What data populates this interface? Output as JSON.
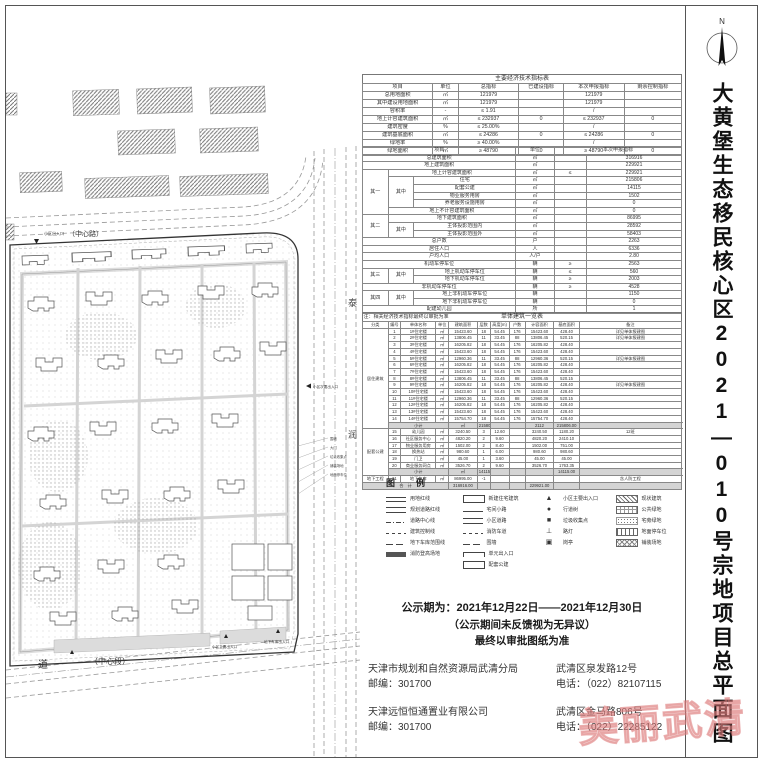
{
  "title": {
    "vertical_text": "大黄堡生态移民核心区2021—010号宗地项目总平面图"
  },
  "north_arrow": {
    "label": "N"
  },
  "map": {
    "road_top_entrance": "小区出入口",
    "road_top_label": "（中心路）",
    "road_bottom_name": "道",
    "road_bottom_section": "（中心段）",
    "entrance_main": "小区主要出入口",
    "entrance_secondary": "小区次要出入口",
    "entrance_garage": "地下车库出入口",
    "road_right_char1": "泰",
    "road_right_char2": "润",
    "annotation_lines": [
      "围墙",
      "大门",
      "垃圾收集点",
      "铺装场地",
      "地面停车位"
    ]
  },
  "tables": {
    "t1": {
      "title": "主要经济技术指标表",
      "widths": [
        22,
        8,
        19,
        14,
        19,
        18
      ],
      "header": [
        "项目",
        "单位",
        "总指标",
        "已建设指标",
        "本次申报指标",
        "剩余控制指标"
      ],
      "rows": [
        [
          "总用地面积",
          "㎡",
          "121979",
          "",
          "121979",
          ""
        ],
        [
          "其中建设用地面积",
          "㎡",
          "121979",
          "",
          "121979",
          ""
        ],
        [
          "容积率",
          "-",
          "≤ 1.91",
          "",
          "/",
          ""
        ],
        [
          "地上计容建筑面积",
          "㎡",
          "≤ 232937",
          "0",
          "≤ 232937",
          "0"
        ],
        [
          "建筑密度",
          "%",
          "≤ 25.00%",
          "",
          "/",
          ""
        ],
        [
          "建筑基底面积",
          "㎡",
          "≤ 24286",
          "0",
          "≤ 24286",
          "0"
        ],
        [
          "绿地率",
          "%",
          "≥ 40.00%",
          "",
          "/",
          ""
        ],
        [
          "绿地面积",
          "㎡",
          "≥ 48790",
          "0",
          "≥ 48790",
          "0"
        ]
      ]
    },
    "t2": {
      "widths": [
        8,
        8,
        32,
        12,
        10,
        30
      ],
      "header": [
        [
          {
            "t": "项目",
            "cs": 3
          },
          {
            "t": "单位"
          },
          {
            "t": "本次申报指标",
            "cs": 2
          }
        ]
      ],
      "rows": [
        [
          {
            "t": "总建筑面积",
            "cs": 3
          },
          "㎡",
          "",
          "316916"
        ],
        [
          {
            "t": "地上建筑面积",
            "cs": 3
          },
          "㎡",
          "",
          "229921"
        ],
        [
          {
            "t": "其一",
            "rs": 6
          },
          {
            "t": "地上计容建筑面积",
            "cs": 2
          },
          "㎡",
          "≤",
          "229921"
        ],
        [
          {
            "t": "其中",
            "rs": 4
          },
          {
            "t": "住宅"
          },
          "㎡",
          "",
          "215806"
        ],
        [
          {
            "t": "配套公建"
          },
          "㎡",
          "",
          "14115"
        ],
        [
          {
            "t": "物业服务用房"
          },
          "㎡",
          "",
          "1502"
        ],
        [
          {
            "t": "养老服务设施用房"
          },
          "㎡",
          "",
          "0"
        ],
        [
          {
            "t": "地上不计容建筑面积",
            "cs": 2
          },
          "㎡",
          "",
          "0"
        ],
        [
          {
            "t": "其二",
            "rs": 3
          },
          {
            "t": "地下建筑面积",
            "cs": 2
          },
          "㎡",
          "",
          "86995"
        ],
        [
          {
            "t": "其中",
            "rs": 2
          },
          {
            "t": "主体投影范围内"
          },
          "㎡",
          "",
          "28592"
        ],
        [
          {
            "t": "主体投影范围外"
          },
          "㎡",
          "",
          "58403"
        ],
        [
          {
            "t": "总户数",
            "cs": 3
          },
          "户",
          "",
          "2263"
        ],
        [
          {
            "t": "居住人口",
            "cs": 3
          },
          "人",
          "",
          "6336"
        ],
        [
          {
            "t": "户均人口",
            "cs": 3
          },
          "人/户",
          "",
          "2.80"
        ],
        [
          {
            "t": "机动车停车位",
            "cs": 3
          },
          "辆",
          "≥",
          "2563"
        ],
        [
          {
            "t": "其三",
            "rs": 2
          },
          {
            "t": "其中",
            "rs": 2
          },
          {
            "t": "地上机动车停车位"
          },
          "辆",
          "≤",
          "560"
        ],
        [
          {
            "t": "地下机动车停车位"
          },
          "辆",
          "≥",
          "2003"
        ],
        [
          {
            "t": "非机动车停车位",
            "cs": 3
          },
          "辆",
          "≥",
          "4528"
        ],
        [
          {
            "t": "其四",
            "rs": 2
          },
          {
            "t": "其中",
            "rs": 2
          },
          {
            "t": "地上非机动车停车位"
          },
          "辆",
          "",
          "1150"
        ],
        [
          {
            "t": "地下非机动车停车位"
          },
          "辆",
          "",
          "0"
        ],
        [
          {
            "t": "配建幼儿园",
            "cs": 3
          },
          "所",
          "",
          "1"
        ]
      ],
      "note": "注：相关经济技术指标最终以审批为准"
    },
    "t3": {
      "title": "单体建筑一览表",
      "widths": [
        8,
        4,
        11,
        4,
        9,
        4,
        6,
        5,
        9,
        8,
        32
      ],
      "header": [
        "分类",
        "编号",
        "单体名称",
        "单位",
        "建筑面积",
        "层数",
        "高度(m)",
        "户数",
        "计容面积",
        "基底面积",
        "备注"
      ],
      "shaded": [
        14,
        21,
        23
      ],
      "rows": [
        [
          {
            "t": "居住建筑",
            "rs": 15
          },
          "1",
          "1#住宅楼",
          "㎡",
          "15423.60",
          "18",
          "54.45",
          "176",
          "15423.60",
          "428.40",
          "详见单体报建图"
        ],
        [
          "2",
          "2#住宅楼",
          "㎡",
          "13806.45",
          "11",
          "33.45",
          "88",
          "13806.45",
          "520.15",
          "详见单体报建图"
        ],
        [
          "3",
          "3#住宅楼",
          "㎡",
          "16205.82",
          "18",
          "54.45",
          "176",
          "16205.82",
          "428.40",
          ""
        ],
        [
          "4",
          "4#住宅楼",
          "㎡",
          "15423.60",
          "18",
          "54.45",
          "176",
          "15423.60",
          "428.40",
          ""
        ],
        [
          "5",
          "5#住宅楼",
          "㎡",
          "12960.36",
          "11",
          "33.45",
          "88",
          "12960.36",
          "520.15",
          "详见单体报建图"
        ],
        [
          "6",
          "6#住宅楼",
          "㎡",
          "16205.82",
          "18",
          "54.45",
          "176",
          "16205.82",
          "428.40",
          ""
        ],
        [
          "7",
          "7#住宅楼",
          "㎡",
          "15423.60",
          "18",
          "54.45",
          "176",
          "15423.60",
          "428.40",
          ""
        ],
        [
          "8",
          "8#住宅楼",
          "㎡",
          "13806.45",
          "11",
          "33.45",
          "88",
          "13806.45",
          "520.15",
          ""
        ],
        [
          "9",
          "9#住宅楼",
          "㎡",
          "16205.82",
          "18",
          "54.45",
          "176",
          "16205.82",
          "428.40",
          "详见单体报建图"
        ],
        [
          "10",
          "10#住宅楼",
          "㎡",
          "15423.60",
          "18",
          "54.45",
          "176",
          "15423.60",
          "428.40",
          ""
        ],
        [
          "11",
          "11#住宅楼",
          "㎡",
          "12960.36",
          "11",
          "33.45",
          "88",
          "12960.36",
          "520.15",
          ""
        ],
        [
          "12",
          "12#住宅楼",
          "㎡",
          "16205.82",
          "18",
          "54.45",
          "176",
          "16205.82",
          "428.40",
          ""
        ],
        [
          "13",
          "13#住宅楼",
          "㎡",
          "15423.60",
          "18",
          "54.45",
          "176",
          "15423.60",
          "428.40",
          ""
        ],
        [
          "14",
          "14#住宅楼",
          "㎡",
          "15754.70",
          "18",
          "54.45",
          "176",
          "15754.70",
          "428.40",
          ""
        ],
        [
          {
            "t": "小计",
            "cs": 3
          },
          "㎡",
          "215806.00",
          "",
          "",
          "2112",
          "215806.00",
          "",
          ""
        ],
        [
          {
            "t": "配套公建",
            "rs": 7
          },
          "15",
          "幼儿园",
          "㎡",
          "3240.50",
          "3",
          "12.60",
          "",
          "3240.50",
          "1180.20",
          "12班"
        ],
        [
          "16",
          "社区服务中心",
          "㎡",
          "4820.20",
          "2",
          "9.60",
          "",
          "4820.20",
          "2410.10",
          ""
        ],
        [
          "17",
          "物业服务用房",
          "㎡",
          "1502.00",
          "2",
          "8.40",
          "",
          "1502.00",
          "751.00",
          ""
        ],
        [
          "18",
          "换热站",
          "㎡",
          "980.60",
          "1",
          "6.00",
          "",
          "980.60",
          "980.60",
          ""
        ],
        [
          "19",
          "门卫",
          "㎡",
          "45.00",
          "1",
          "3.60",
          "",
          "45.00",
          "45.00",
          ""
        ],
        [
          "20",
          "商业服务网点",
          "㎡",
          "3526.70",
          "2",
          "9.60",
          "",
          "3526.70",
          "1763.35",
          ""
        ],
        [
          {
            "t": "小计",
            "cs": 3
          },
          "㎡",
          "14115.00",
          "",
          "",
          "",
          "14115.00",
          "",
          ""
        ],
        [
          {
            "t": "地下工程"
          },
          "21",
          "地下车库",
          "㎡",
          "86995.00",
          "-1",
          "",
          "",
          "",
          "",
          "含人防工程"
        ],
        [
          {
            "t": "合　计",
            "cs": 4
          },
          "316916.00",
          "",
          "",
          "",
          "229921.00",
          "",
          ""
        ]
      ]
    }
  },
  "legend": {
    "title": "图　例",
    "groups": [
      [
        {
          "sym": "dline",
          "label": "用地红线"
        },
        {
          "sym": "dbl",
          "label": "规划道路红线"
        },
        {
          "sym": "dashdot",
          "label": "道路中心线"
        },
        {
          "sym": "dash",
          "label": "建筑控制线"
        },
        {
          "sym": "ldash",
          "label": "地下车库范围线"
        },
        {
          "sym": "solid",
          "label": "消防登高场地"
        }
      ],
      [
        {
          "sym": "rect",
          "label": "新建住宅建筑"
        },
        {
          "sym": "line",
          "label": "宅间小路"
        },
        {
          "sym": "dbl",
          "label": "小区道路"
        },
        {
          "sym": "dash",
          "label": "消防车道"
        },
        {
          "sym": "ldash",
          "label": "围墙"
        },
        {
          "sym": "bracket",
          "label": "单元出入口"
        },
        {
          "sym": "rect",
          "label": "配套公建"
        }
      ],
      [
        {
          "sym": "tri",
          "label": "小区主要出入口"
        },
        {
          "sym": "dot",
          "label": "行道树"
        },
        {
          "sym": "sq",
          "label": "垃圾收集点"
        },
        {
          "sym": "tee",
          "label": "路灯"
        },
        {
          "sym": "box",
          "label": "岗亭"
        }
      ],
      [
        {
          "sym": "hatch",
          "label": "现状建筑"
        },
        {
          "sym": "grid",
          "label": "公共绿地"
        },
        {
          "sym": "dots",
          "label": "宅旁绿地"
        },
        {
          "sym": "vbars",
          "label": "地面停车位"
        },
        {
          "sym": "xhatch",
          "label": "铺装场地"
        }
      ]
    ]
  },
  "notice": {
    "line1": "公示期为：2021年12月22日——2021年12月30日",
    "line2": "（公示期间未反馈视为无异议）",
    "line3": "最终以审批图纸为准"
  },
  "contacts": {
    "bureau": {
      "org": "天津市规划和自然资源局武清分局",
      "zip": "邮编：301700",
      "addr": "武清区泉发路12号",
      "tel": "电话：（022）82107115"
    },
    "developer": {
      "org": "天津远恒恒通置业有限公司",
      "zip": "邮编：301700",
      "addr": "武清区金马路806号",
      "tel": "电话：（022）22285122"
    }
  },
  "watermark": {
    "text": "美丽武清",
    "color": "#e28c8c"
  }
}
